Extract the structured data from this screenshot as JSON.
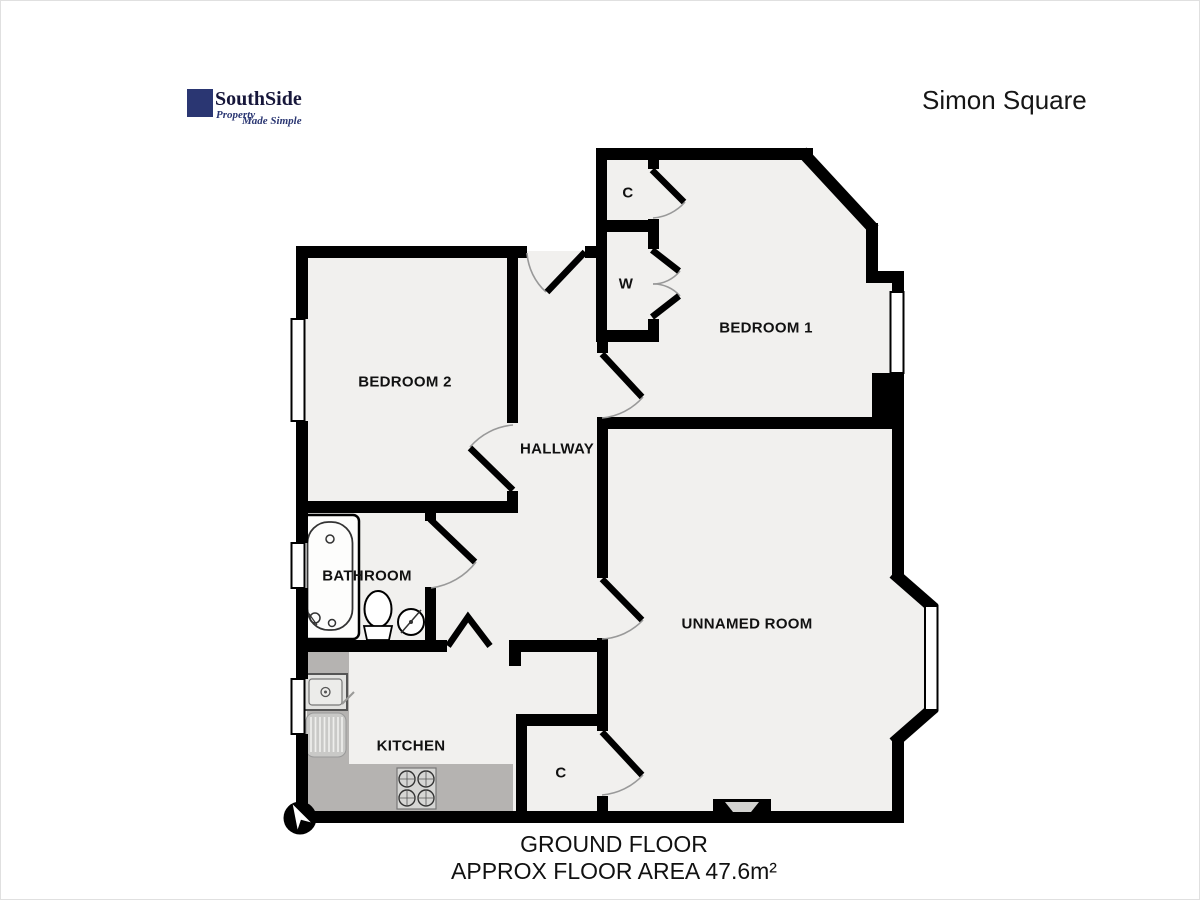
{
  "header": {
    "logo": {
      "name": "SouthSide",
      "tagline_word1": "Property",
      "tagline_word2": "Made Simple"
    },
    "property_title": "Simon Square"
  },
  "plan": {
    "rooms": {
      "bedroom1": "BEDROOM 1",
      "bedroom2": "BEDROOM 2",
      "hallway": "HALLWAY",
      "bathroom": "BATHROOM",
      "kitchen": "KITCHEN",
      "unnamed_room": "UNNAMED ROOM",
      "closet_top": "C",
      "wardrobe": "W",
      "closet_bottom": "C"
    }
  },
  "footer": {
    "floor_label": "GROUND FLOOR",
    "area_label": "APPROX FLOOR AREA 47.6m²"
  },
  "colors": {
    "brand_navy": "#2a3672",
    "wall_black": "#000000",
    "floor_light": "#f1f0ee",
    "counter_gray": "#b5b3b1"
  }
}
